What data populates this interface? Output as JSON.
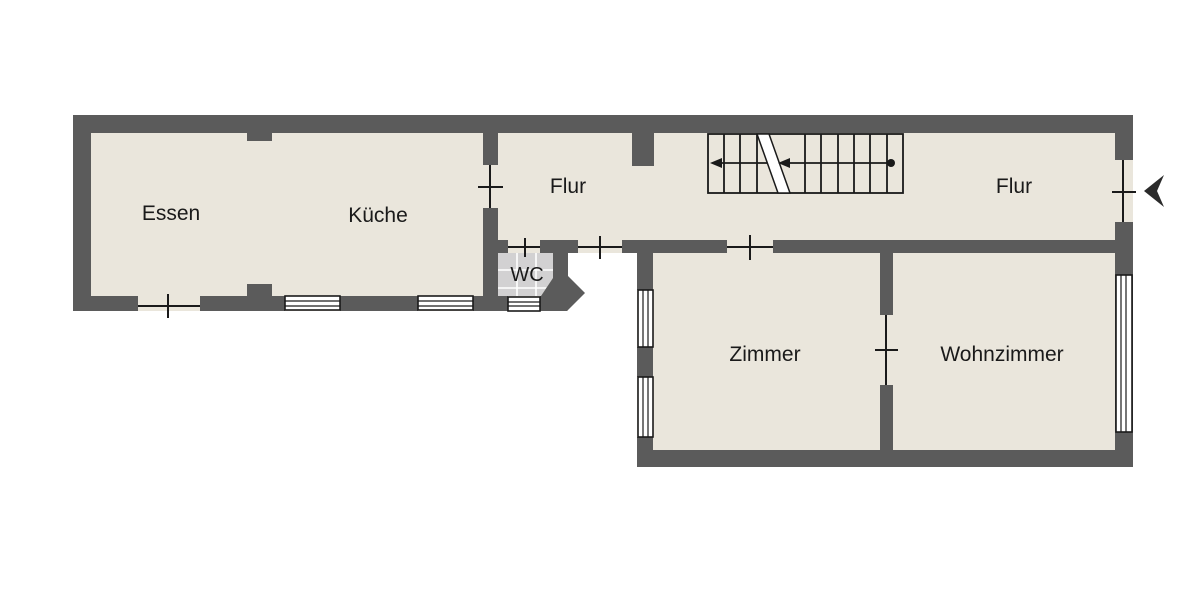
{
  "floorplan": {
    "type": "floor-plan",
    "rooms": [
      {
        "label": "Essen"
      },
      {
        "label": "Küche"
      },
      {
        "label": "Flur"
      },
      {
        "label": "WC"
      },
      {
        "label": "Flur"
      },
      {
        "label": "Zimmer"
      },
      {
        "label": "Wohnzimmer"
      }
    ],
    "colors": {
      "wall": "#5b5b5b",
      "floor": "#eae6dc",
      "tile": "#d2d1d2",
      "tile_grid": "#ffffff",
      "line": "#1a1a1a",
      "window_fill": "#ffffff",
      "background": "#ffffff",
      "arrow": "#2b2b2b"
    }
  }
}
